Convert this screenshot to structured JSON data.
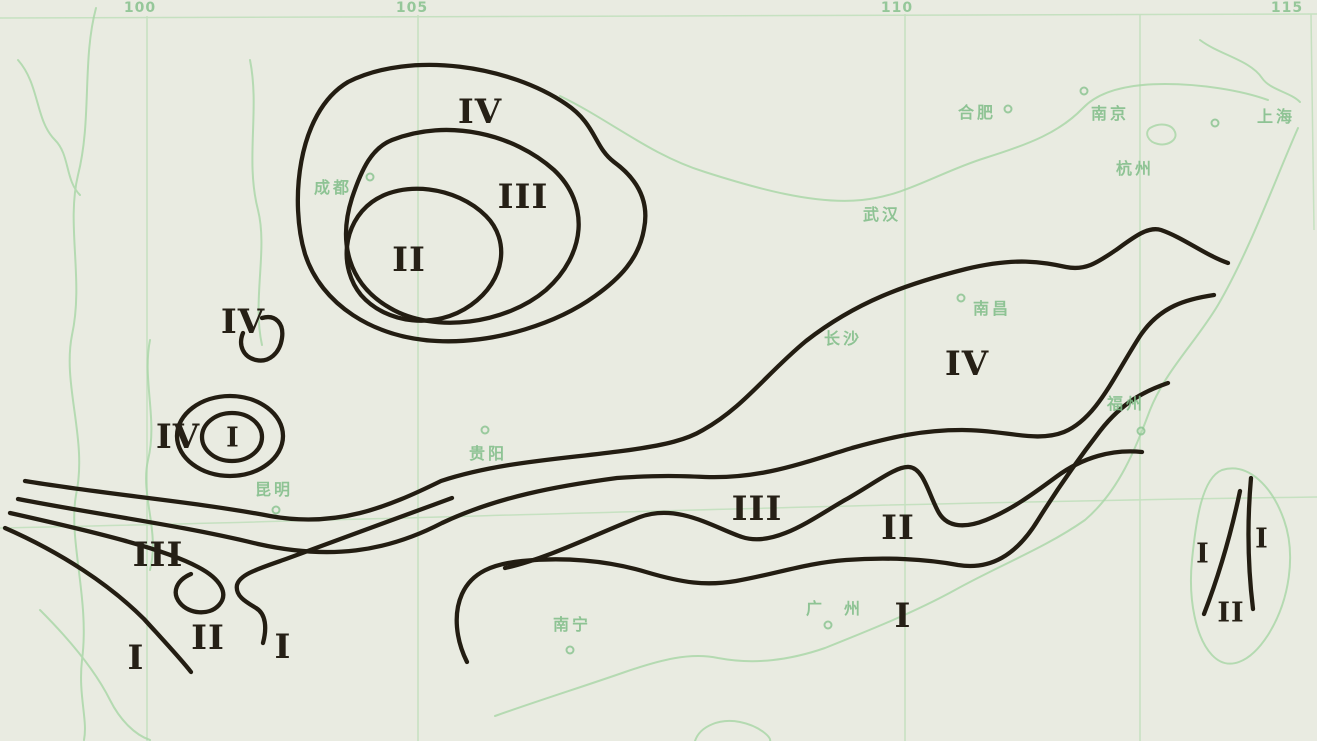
{
  "map": {
    "description": "Contour-style zoning map of southern China with Roman-numeral zones I–IV",
    "colors": {
      "paper": "#e9ebe1",
      "zone_line": "#231d12",
      "geo_green": "#a8d6a6",
      "label_green": "#7fbd87",
      "numeral_ink": "#262016"
    },
    "meridians": [
      {
        "label": "100",
        "x": 140
      },
      {
        "label": "105",
        "x": 412
      },
      {
        "label": "110",
        "x": 897
      },
      {
        "label": "115",
        "x": 1287
      }
    ],
    "zone_labels": [
      {
        "numeral": "IV",
        "x": 480,
        "y": 112,
        "small": false
      },
      {
        "numeral": "III",
        "x": 523,
        "y": 197,
        "small": false
      },
      {
        "numeral": "II",
        "x": 409,
        "y": 260,
        "small": false
      },
      {
        "numeral": "IV",
        "x": 243,
        "y": 322,
        "small": false
      },
      {
        "numeral": "IV",
        "x": 178,
        "y": 437,
        "small": false
      },
      {
        "numeral": "I",
        "x": 233,
        "y": 438,
        "small": true
      },
      {
        "numeral": "IV",
        "x": 967,
        "y": 364,
        "small": false
      },
      {
        "numeral": "III",
        "x": 757,
        "y": 509,
        "small": false
      },
      {
        "numeral": "II",
        "x": 898,
        "y": 528,
        "small": false
      },
      {
        "numeral": "I",
        "x": 903,
        "y": 616,
        "small": false
      },
      {
        "numeral": "III",
        "x": 158,
        "y": 555,
        "small": false
      },
      {
        "numeral": "I",
        "x": 136,
        "y": 658,
        "small": false
      },
      {
        "numeral": "II",
        "x": 208,
        "y": 638,
        "small": false
      },
      {
        "numeral": "I",
        "x": 283,
        "y": 647,
        "small": false
      },
      {
        "numeral": "I",
        "x": 1203,
        "y": 554,
        "small": true
      },
      {
        "numeral": "I",
        "x": 1262,
        "y": 539,
        "small": true
      },
      {
        "numeral": "II",
        "x": 1231,
        "y": 613,
        "small": true
      }
    ],
    "cities": [
      {
        "name": "成都",
        "x": 333,
        "y": 186,
        "spread": false,
        "marker": {
          "x": 370,
          "y": 177
        }
      },
      {
        "name": "合肥",
        "x": 977,
        "y": 111,
        "spread": false,
        "marker": {
          "x": 1008,
          "y": 109
        }
      },
      {
        "name": "南京",
        "x": 1110,
        "y": 112,
        "spread": false,
        "marker": {
          "x": 1084,
          "y": 91
        }
      },
      {
        "name": "上海",
        "x": 1276,
        "y": 115,
        "spread": false,
        "marker": {
          "x": 1215,
          "y": 123
        }
      },
      {
        "name": "杭州",
        "x": 1135,
        "y": 167,
        "spread": false,
        "marker": null
      },
      {
        "name": "武汉",
        "x": 882,
        "y": 213,
        "spread": false,
        "marker": null
      },
      {
        "name": "南昌",
        "x": 992,
        "y": 307,
        "spread": false,
        "marker": {
          "x": 961,
          "y": 298
        }
      },
      {
        "name": "长沙",
        "x": 843,
        "y": 337,
        "spread": false,
        "marker": null
      },
      {
        "name": "贵阳",
        "x": 488,
        "y": 452,
        "spread": false,
        "marker": {
          "x": 485,
          "y": 430
        }
      },
      {
        "name": "昆明",
        "x": 274,
        "y": 488,
        "spread": false,
        "marker": {
          "x": 276,
          "y": 510
        }
      },
      {
        "name": "南宁",
        "x": 572,
        "y": 623,
        "spread": false,
        "marker": {
          "x": 570,
          "y": 650
        }
      },
      {
        "name": "广州",
        "x": 844,
        "y": 607,
        "spread": true,
        "marker": {
          "x": 828,
          "y": 625
        }
      },
      {
        "name": "福州",
        "x": 1126,
        "y": 402,
        "spread": false,
        "marker": {
          "x": 1141,
          "y": 431
        }
      }
    ]
  }
}
